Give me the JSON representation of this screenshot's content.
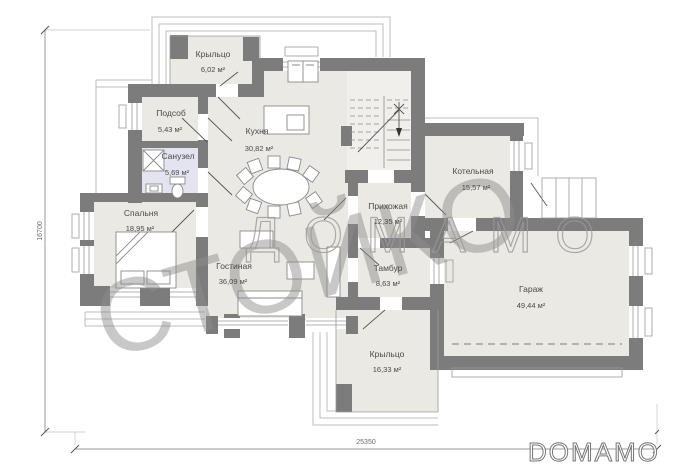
{
  "watermark": {
    "diagonal": "СТОЙКО",
    "horizontal": "ДОМАМО"
  },
  "logo": {
    "text": "DOMAMO"
  },
  "dimensions": {
    "left": "16700",
    "bottom": "25350"
  },
  "rooms": [
    {
      "id": "porch-top",
      "name": "Крыльцо",
      "area": "6,02 м²"
    },
    {
      "id": "utility",
      "name": "Подсоб",
      "area": "5,43 м²"
    },
    {
      "id": "bathroom",
      "name": "Санузел",
      "area": "5,69 м²"
    },
    {
      "id": "bedroom",
      "name": "Спальня",
      "area": "18,95 м²"
    },
    {
      "id": "kitchen",
      "name": "Кухня",
      "area": "30,82 м²"
    },
    {
      "id": "living",
      "name": "Гостиная",
      "area": "36,09 м²"
    },
    {
      "id": "hallway",
      "name": "Прихожая",
      "area": "12,35 м²"
    },
    {
      "id": "boiler",
      "name": "Котельная",
      "area": "15,57 м²"
    },
    {
      "id": "vestibule",
      "name": "Тамбур",
      "area": "8,63 м²"
    },
    {
      "id": "garage",
      "name": "Гараж",
      "area": "49,44 м²"
    },
    {
      "id": "porch-bottom",
      "name": "Крыльцо",
      "area": "16,33 м²"
    }
  ],
  "colors": {
    "wall": "#7c7c7c",
    "floor": "#ebe9e3",
    "bath_floor": "#e4e4f1",
    "watermark": "#8d8d8d"
  }
}
